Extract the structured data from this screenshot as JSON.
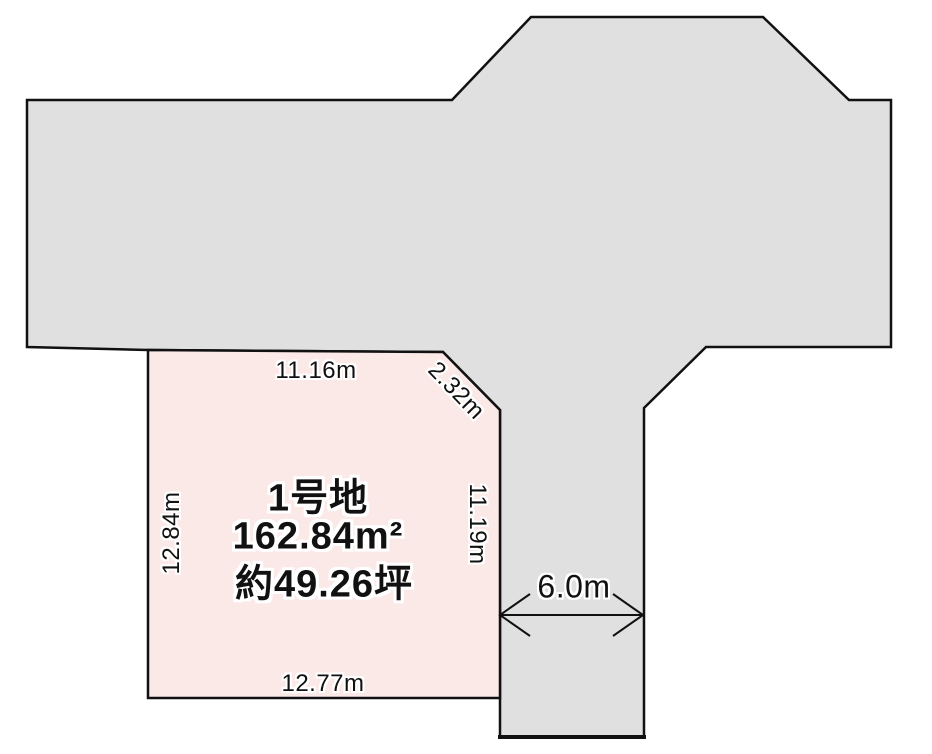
{
  "diagram": {
    "plot": {
      "name": "1号地",
      "area_sqm": "162.84m²",
      "area_tsubo": "約49.26坪"
    },
    "dimensions": {
      "top": "11.16m",
      "corner_cut": "2.32m",
      "left": "12.84m",
      "right": "11.19m",
      "bottom": "12.77m",
      "road_width": "6.0m"
    },
    "colors": {
      "road_fill": "#e0e0e0",
      "plot_fill": "#fbe9e8",
      "outline": "#111111"
    }
  }
}
